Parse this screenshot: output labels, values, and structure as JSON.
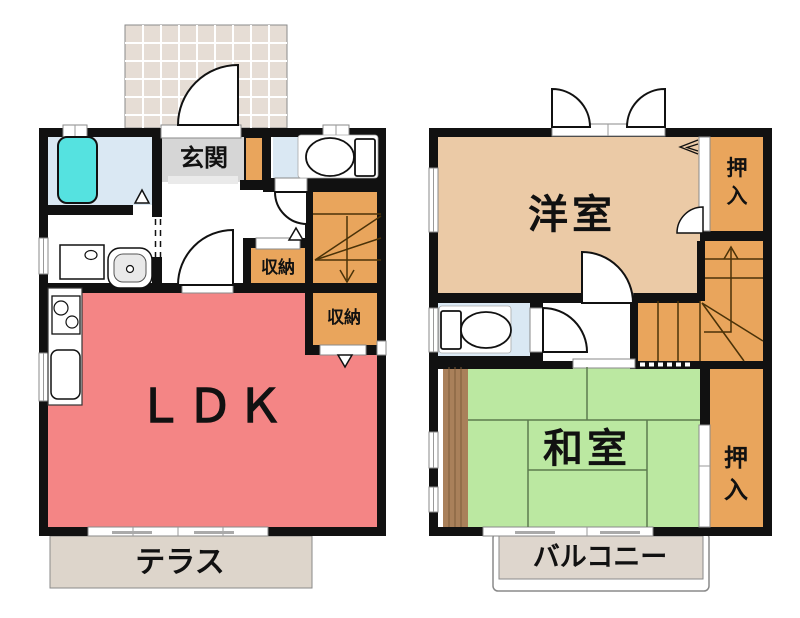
{
  "plan": {
    "floor1": {
      "entrance_label": "玄関",
      "ldk_label": "ＬＤＫ",
      "storage1_label": "収納",
      "storage2_label": "収納",
      "terrace_label": "テラス"
    },
    "floor2": {
      "western_room_label": "洋室",
      "japanese_room_label": "和室",
      "closet_upper_chars": [
        "押",
        "入"
      ],
      "closet_lower_chars": [
        "押",
        "入"
      ],
      "balcony_label": "バルコニー"
    },
    "colors": {
      "wall": "#111111",
      "ldk": "#F48585",
      "western_room": "#EBCAA6",
      "japanese_room": "#BBE8A1",
      "storage": "#E9A55C",
      "stairs": "#E9A55C",
      "wet_room": "#DAE8F3",
      "bathtub": "#55E2E0",
      "genkan": "#D6D6D6",
      "porch_tile": "#E6DDD5",
      "terrace": "#DDD5CB",
      "balcony": "#DED6CD",
      "wood_strip": "#A9805A"
    }
  }
}
